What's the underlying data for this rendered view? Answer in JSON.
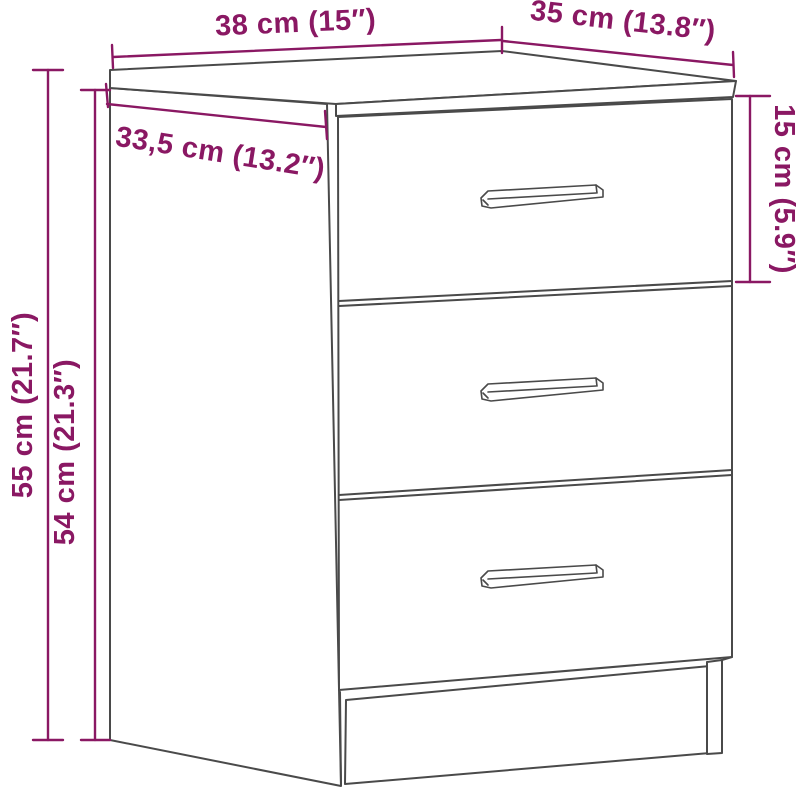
{
  "diagram": {
    "subject": "3-drawer nightstand line drawing with measurements",
    "drawer_count": 3,
    "handle_count": 3
  },
  "colors": {
    "dimension": "#8a1863",
    "outline": "#4a4a4a",
    "background": "#ffffff"
  },
  "dimensions": {
    "top_width": {
      "label": "38 cm (15″)"
    },
    "top_depth": {
      "label": "35 cm (13.8″)"
    },
    "top_inner_width": {
      "label": "33,5 cm (13.2″)"
    },
    "top_drawer_height": {
      "label": "15 cm (5.9″)"
    },
    "total_height": {
      "label": "55 cm (21.7″)"
    },
    "side_height": {
      "label": "54 cm (21.3″)"
    }
  }
}
